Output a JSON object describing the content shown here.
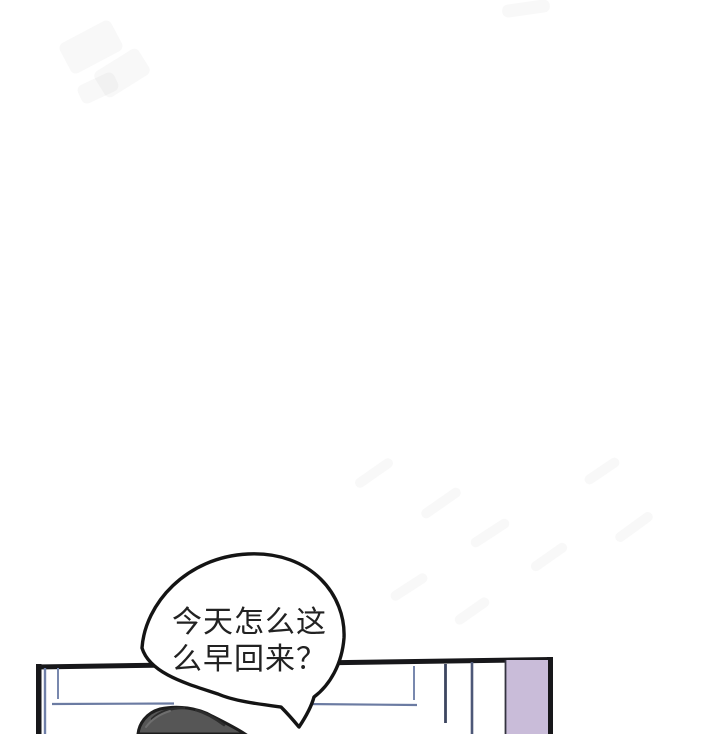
{
  "page": {
    "width": 720,
    "height": 734,
    "background": "#ffffff",
    "description_label": "comic page panel"
  },
  "speech_bubble": {
    "text": "今天怎么这么早回来？",
    "lines": [
      "今天怎么这",
      "么早回来？"
    ],
    "fill": "#ffffff",
    "outline_color": "#141414",
    "text_color": "#222222"
  },
  "panel": {
    "border_color": "#17171a",
    "wall_line_color": "#6f7fa8",
    "wall_line_light_color": "#7888ae",
    "wall_line_dark_color": "#3d4660",
    "wall_line_mid_color": "#4d5878",
    "baseboard_line_color": "#6b7ba2",
    "door_fill": "#c9bcd9",
    "door_edge_color": "#33333f",
    "hair_fill": "#565656",
    "hair_outline": "#1d1d1d",
    "hair_streak_dark": "#2c2c2c",
    "hair_streak_light": "#6e6e6e"
  }
}
